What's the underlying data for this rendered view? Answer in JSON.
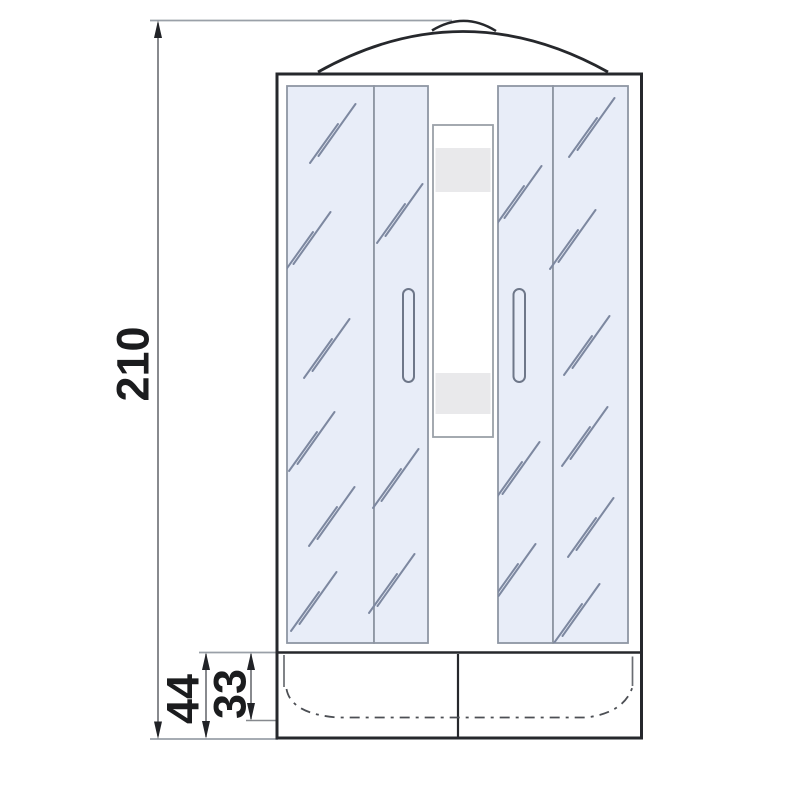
{
  "diagram": {
    "type": "technical-drawing",
    "dimensions": {
      "overall_height": "210",
      "base_height": "44",
      "tray_depth": "33"
    },
    "palette": {
      "outline": "#26282c",
      "glass_fill": "#e8edf8",
      "glass_stroke": "#8e96a3",
      "reflection": "#7d88a0",
      "shelf_fill": "#e9e9eb",
      "dimension_text": "#1b1c1e",
      "extension_line": "#9aa0a8",
      "background": "#ffffff"
    }
  }
}
